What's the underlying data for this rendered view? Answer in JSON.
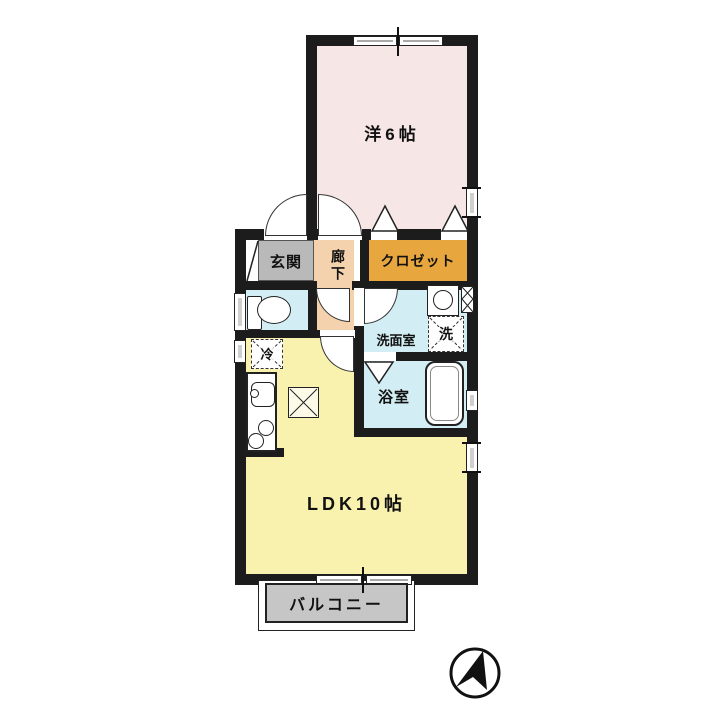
{
  "floorplan": {
    "rooms": {
      "western_room": {
        "label": "洋6帖",
        "color": "#f7e6e6"
      },
      "ldk": {
        "label": "LDK10帖",
        "color": "#f8f2ae"
      },
      "genkan": {
        "label": "玄関",
        "color": "#b9b9b9"
      },
      "corridor": {
        "label": "廊下",
        "color": "#f4d2ad"
      },
      "closet": {
        "label": "クロゼット",
        "color": "#e7a63e"
      },
      "washroom": {
        "label": "洗面室",
        "color": "#d2edf3"
      },
      "bathroom": {
        "label": "浴室",
        "color": "#d2edf3"
      },
      "balcony": {
        "label": "バルコニー",
        "color": "#c6c6c6"
      }
    },
    "fixtures": {
      "washing_machine": {
        "label": "洗"
      },
      "refrigerator": {
        "label": "冷"
      }
    },
    "symbols": {
      "north_arrow": "compass-north-arrow",
      "wall_color": "#1c1c1c"
    }
  }
}
